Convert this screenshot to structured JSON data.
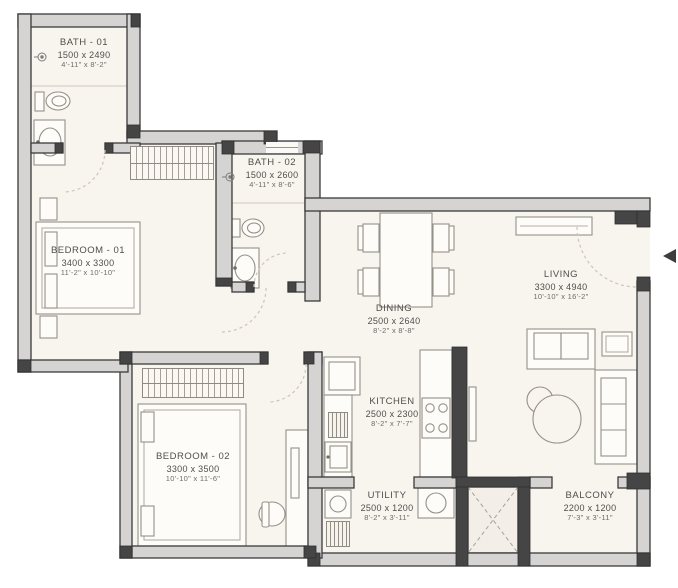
{
  "colors": {
    "wall_fill": "#d5d4d2",
    "wall_dark": "#454545",
    "wall_stroke": "#3b3b3b",
    "floor": "#f8f4ee",
    "furniture_line": "#969088",
    "door_arc": "#cfc5b6",
    "label_text": "#4f4f4f"
  },
  "icons": {
    "entry_arrow_icon": "left-triangle",
    "fixture_point_icon": "circle-with-dot"
  },
  "rooms": {
    "bath1": {
      "name": "BATH - 01",
      "dim_mm": "1500 x 2490",
      "dim_ft": "4'-11\" x 8'-2\""
    },
    "bath2": {
      "name": "BATH - 02",
      "dim_mm": "1500 x 2600",
      "dim_ft": "4'-11\" x 8'-6\""
    },
    "bedroom1": {
      "name": "BEDROOM - 01",
      "dim_mm": "3400 x 3300",
      "dim_ft": "11'-2\" x 10'-10\""
    },
    "bedroom2": {
      "name": "BEDROOM - 02",
      "dim_mm": "3300 x 3500",
      "dim_ft": "10'-10\" x 11'-6\""
    },
    "dining": {
      "name": "DINING",
      "dim_mm": "2500 x 2640",
      "dim_ft": "8'-2\" x 8'-8\""
    },
    "living": {
      "name": "LIVING",
      "dim_mm": "3300 x 4940",
      "dim_ft": "10'-10\" x 16'-2\""
    },
    "kitchen": {
      "name": "KITCHEN",
      "dim_mm": "2500 x 2300",
      "dim_ft": "8'-2\" x 7'-7\""
    },
    "utility": {
      "name": "UTILITY",
      "dim_mm": "2500 x 1200",
      "dim_ft": "8'-2\" x 3'-11\""
    },
    "balcony": {
      "name": "BALCONY",
      "dim_mm": "2200 x 1200",
      "dim_ft": "7'-3\" x 3'-11\""
    }
  }
}
